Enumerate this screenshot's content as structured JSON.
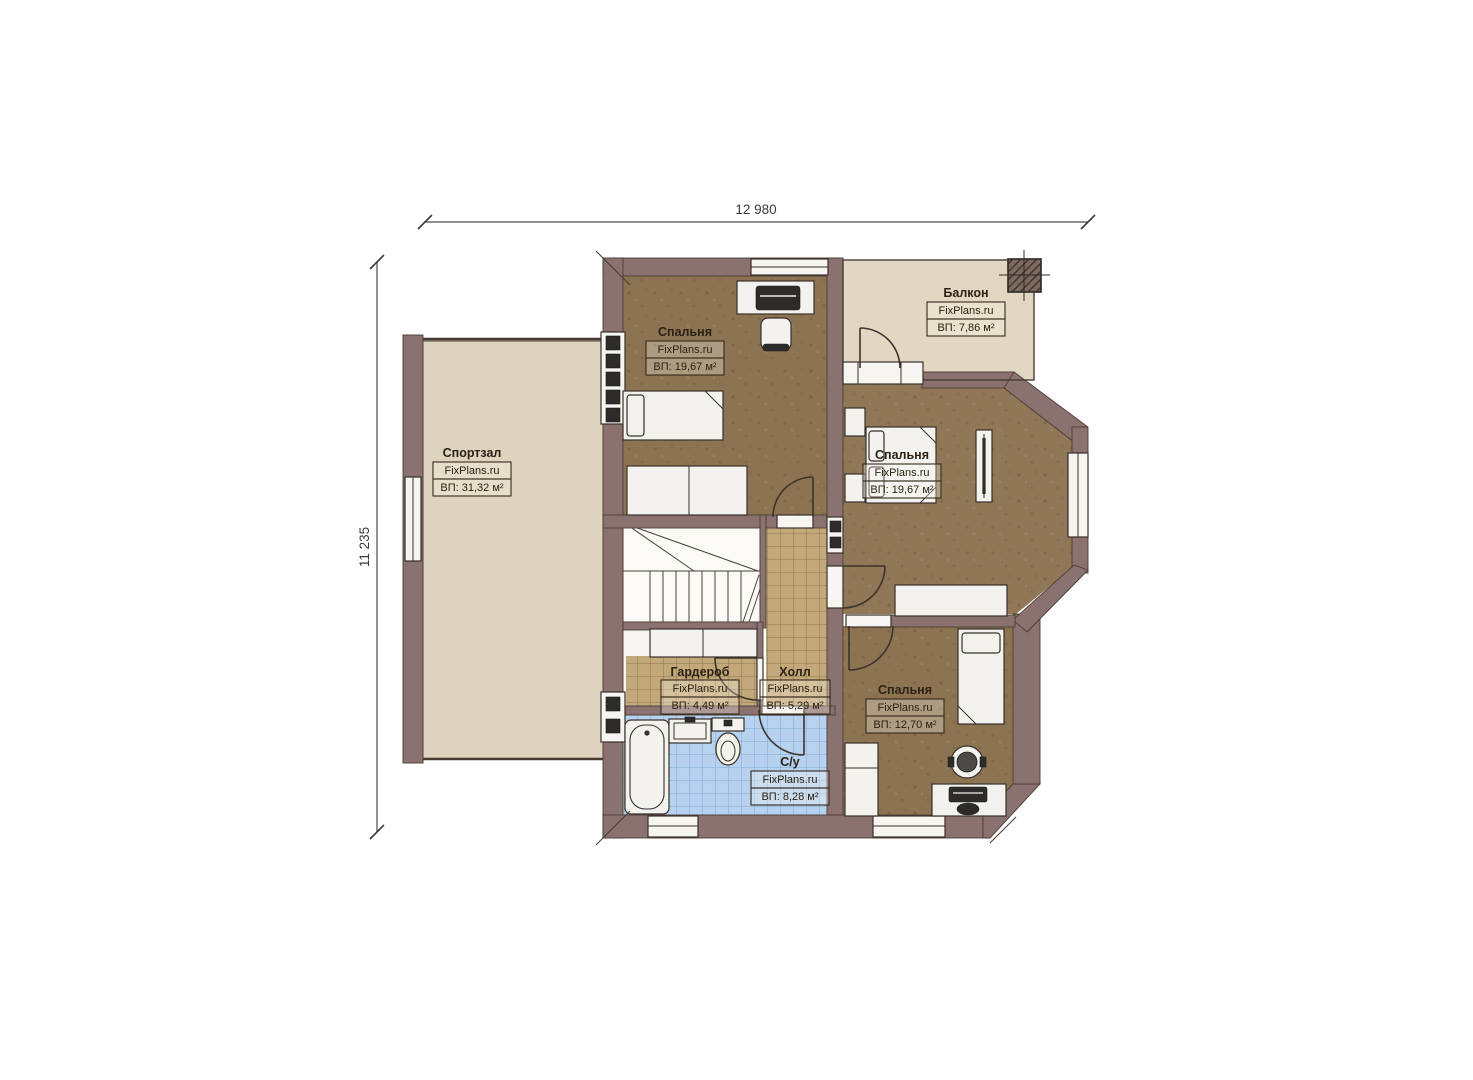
{
  "dimensions": {
    "width_label": "12 980",
    "height_label": "11 235"
  },
  "rooms": {
    "gym": {
      "name": "Спортзал",
      "watermark": "FixPlans.ru",
      "area": "ВП: 31,32 м²"
    },
    "bedroom_top_left": {
      "name": "Спальня",
      "watermark": "FixPlans.ru",
      "area": "ВП: 19,67 м²"
    },
    "balcony": {
      "name": "Балкон",
      "watermark": "FixPlans.ru",
      "area": "ВП: 7,86 м²"
    },
    "bedroom_right": {
      "name": "Спальня",
      "watermark": "FixPlans.ru",
      "area": "ВП: 19,67 м²"
    },
    "wardrobe": {
      "name": "Гардероб",
      "watermark": "FixPlans.ru",
      "area": "ВП: 4,49 м²"
    },
    "hall": {
      "name": "Холл",
      "watermark": "FixPlans.ru",
      "area": "ВП: 5,29 м²"
    },
    "bathroom": {
      "name": "С/у",
      "watermark": "FixPlans.ru",
      "area": "ВП: 8,28 м²"
    },
    "bedroom_bottom_right": {
      "name": "Спальня",
      "watermark": "FixPlans.ru",
      "area": "ВП: 12,70 м²"
    }
  },
  "colors": {
    "wall": "#8b7170",
    "floor_bedroom": "#8c7452",
    "floor_gym": "#ded3bc",
    "floor_balcony": "#e2d8c2",
    "tile_hall": "#c3a97a",
    "tile_bath": "#b6d2ee"
  }
}
